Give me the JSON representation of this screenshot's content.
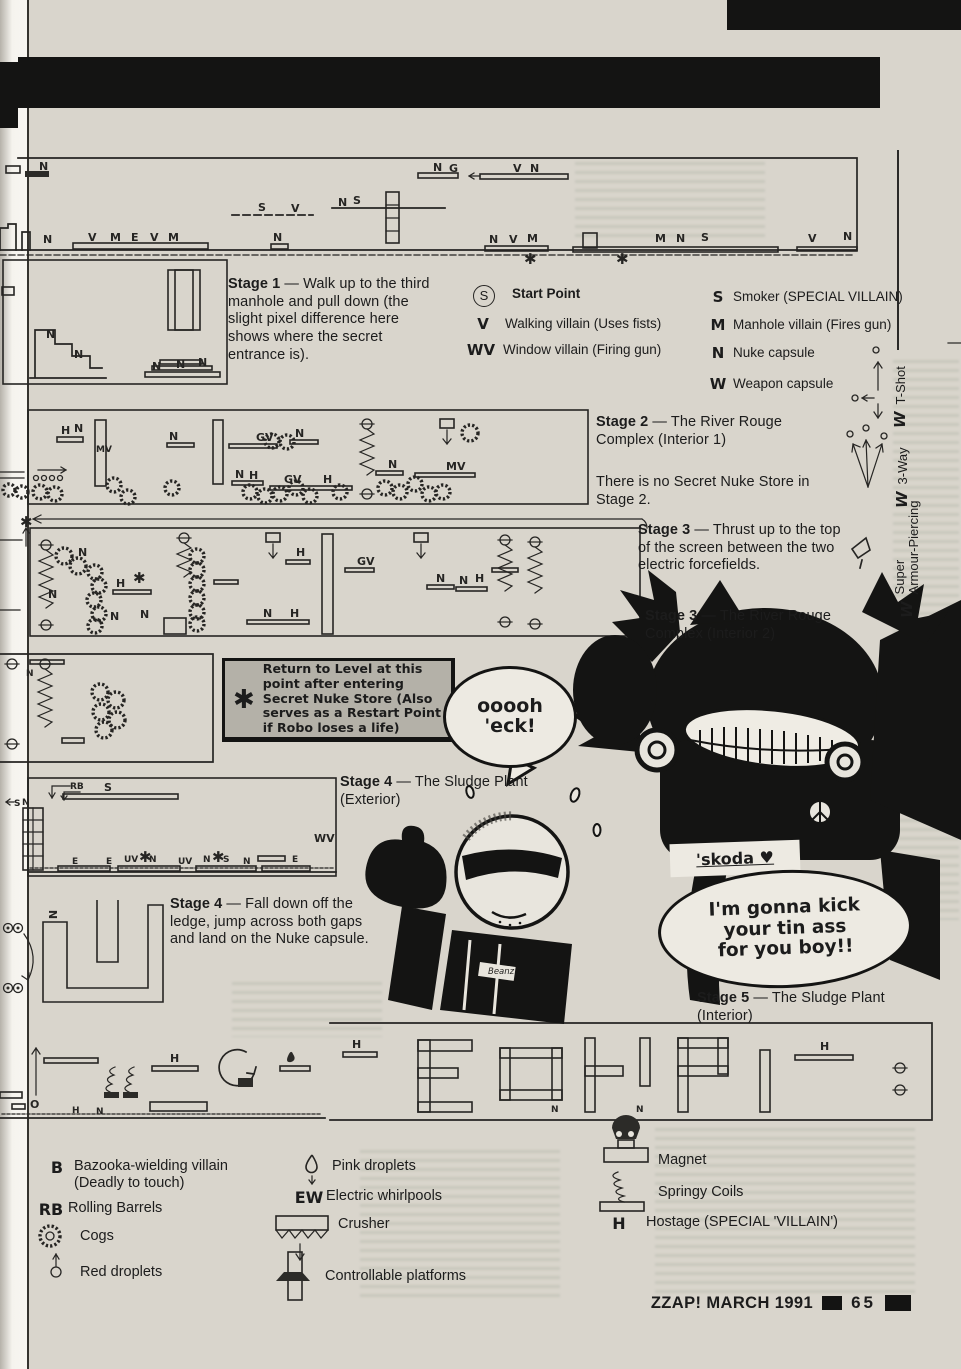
{
  "footer": {
    "title": "ZZAP! MARCH 1991",
    "page": "65"
  },
  "stage_notes": {
    "stage1": {
      "label": "Stage 1",
      "body": "— Walk up to the third manhole and pull down (the slight pixel difference here shows where the secret entrance is)."
    },
    "stage2": {
      "label": "Stage 2",
      "body": "— The River Rouge Complex (Interior 1)"
    },
    "stage2_note": "There is no Secret Nuke Store in Stage 2.",
    "stage3a": {
      "label": "Stage 3",
      "body": "— Thrust up to the top of the screen between the two electric forcefields."
    },
    "stage3b": {
      "label": "Stage 3",
      "body": "— The River Rouge Complex (Interior 2)"
    },
    "stage4a": {
      "label": "Stage 4",
      "body": "— The Sludge Plant (Exterior)"
    },
    "stage4b": {
      "label": "Stage 4",
      "body": "— Fall down off the ledge, jump across both gaps and land on the Nuke capsule."
    },
    "stage5": {
      "label": "Stage 5",
      "body": "— The Sludge Plant (Interior)"
    }
  },
  "restart_box": {
    "symbol": "✱",
    "text": "Return to Level at this point after entering Secret Nuke Store (Also serves as a Restart Point if Robo loses a life)"
  },
  "key_left": [
    {
      "symbol": "S",
      "label": "Start Point"
    },
    {
      "symbol": "V",
      "label": "Walking villain (Uses fists)"
    },
    {
      "symbol": "WV",
      "label": "Window villain (Firing gun)"
    }
  ],
  "key_right": [
    {
      "symbol": "S",
      "label": "Smoker (SPECIAL VILLAIN)"
    },
    {
      "symbol": "M",
      "label": "Manhole villain (Fires gun)"
    },
    {
      "symbol": "N",
      "label": "Nuke capsule"
    },
    {
      "symbol": "W",
      "label": "Weapon capsule"
    }
  ],
  "weapons": [
    {
      "symbol": "W",
      "label": "T-Shot"
    },
    {
      "symbol": "W",
      "label": "3-Way"
    },
    {
      "symbol": "W",
      "label_line1": "Super",
      "label_line2": "Armour-Piercing"
    }
  ],
  "legend_bottom": {
    "col1": [
      {
        "symbol": "B",
        "label": "Bazooka-wielding villain (Deadly to touch)"
      },
      {
        "symbol": "RB",
        "label": "Rolling Barrels"
      },
      {
        "icon": "cogs-icon",
        "label": "Cogs"
      },
      {
        "icon": "red-droplets-icon",
        "label": "Red droplets"
      }
    ],
    "col2": [
      {
        "icon": "pink-droplets-icon",
        "label": "Pink droplets"
      },
      {
        "symbol": "EW",
        "label": "Electric whirlpools"
      },
      {
        "icon": "crusher-icon",
        "label": "Crusher"
      },
      {
        "icon": "controllable-platforms-icon",
        "label": "Controllable platforms"
      }
    ],
    "col3": [
      {
        "icon": "magnet-icon",
        "label": "Magnet"
      },
      {
        "icon": "springy-coils-icon",
        "label": "Springy Coils"
      },
      {
        "symbol": "H",
        "label": "Hostage (SPECIAL 'VILLAIN')"
      }
    ]
  },
  "speech": {
    "robocop": "ooooh\n'eck!",
    "skoda": "'skoda ♥",
    "villain": "I'm gonna kick\nyour tin ass\nfor you boy!!"
  },
  "colors": {
    "paper": "#d9d5cc",
    "ink": "#262523",
    "bar_black": "#141413",
    "box_gray": "#b4b1a8"
  },
  "map_markers": [
    {
      "map": "strip1",
      "items": [
        [
          39,
          170,
          "N"
        ],
        [
          43,
          243,
          "N"
        ],
        [
          88,
          241,
          "V"
        ],
        [
          110,
          241,
          "M"
        ],
        [
          131,
          241,
          "E"
        ],
        [
          150,
          241,
          "V"
        ],
        [
          168,
          241,
          "M"
        ],
        [
          258,
          211,
          "S"
        ],
        [
          291,
          212,
          "V"
        ],
        [
          273,
          241,
          "N"
        ],
        [
          338,
          206,
          "N"
        ],
        [
          353,
          204,
          "S"
        ],
        [
          433,
          171,
          "N"
        ],
        [
          449,
          172,
          "G"
        ],
        [
          513,
          172,
          "V"
        ],
        [
          530,
          172,
          "N"
        ],
        [
          489,
          243,
          "N"
        ],
        [
          509,
          243,
          "V"
        ],
        [
          527,
          242,
          "M"
        ],
        [
          524,
          264,
          "✱",
          "big"
        ],
        [
          616,
          264,
          "✱",
          "big"
        ],
        [
          655,
          242,
          "M"
        ],
        [
          676,
          242,
          "N"
        ],
        [
          701,
          241,
          "S"
        ],
        [
          808,
          242,
          "V"
        ],
        [
          843,
          240,
          "N"
        ]
      ]
    },
    {
      "map": "inset1",
      "items": [
        [
          46,
          338,
          "N"
        ],
        [
          74,
          358,
          "N"
        ],
        [
          152,
          370,
          "N"
        ],
        [
          176,
          368,
          "N"
        ],
        [
          198,
          366,
          "N"
        ]
      ]
    },
    {
      "map": "strip2",
      "items": [
        [
          61,
          434,
          "H"
        ],
        [
          74,
          432,
          "N"
        ],
        [
          96,
          452,
          "MV",
          "sm"
        ],
        [
          169,
          440,
          "N"
        ],
        [
          256,
          441,
          "GV"
        ],
        [
          295,
          437,
          "N"
        ],
        [
          235,
          478,
          "N"
        ],
        [
          249,
          479,
          "H"
        ],
        [
          284,
          483,
          "GV"
        ],
        [
          323,
          483,
          "H"
        ],
        [
          388,
          468,
          "N"
        ],
        [
          446,
          470,
          "MV"
        ]
      ]
    },
    {
      "map": "strip3",
      "items": [
        [
          20,
          527,
          "✱",
          "big"
        ],
        [
          78,
          556,
          "N"
        ],
        [
          48,
          598,
          "N"
        ],
        [
          116,
          587,
          "H"
        ],
        [
          133,
          583,
          "✱",
          "big"
        ],
        [
          110,
          620,
          "N"
        ],
        [
          140,
          618,
          "N"
        ],
        [
          296,
          556,
          "H"
        ],
        [
          263,
          617,
          "N"
        ],
        [
          290,
          617,
          "H"
        ],
        [
          357,
          565,
          "GV"
        ],
        [
          436,
          582,
          "N"
        ],
        [
          459,
          584,
          "N"
        ],
        [
          475,
          582,
          "H"
        ]
      ]
    },
    {
      "map": "store",
      "items": [
        [
          26,
          676,
          "N",
          "sm"
        ]
      ]
    },
    {
      "map": "strip4",
      "items": [
        [
          70,
          789,
          "RB",
          "sm"
        ],
        [
          104,
          791,
          "S"
        ],
        [
          14,
          806,
          "S",
          "sm"
        ],
        [
          22,
          805,
          "N",
          "sm"
        ],
        [
          314,
          842,
          "WV"
        ],
        [
          72,
          864,
          "E",
          "sm"
        ],
        [
          106,
          864,
          "E",
          "sm"
        ],
        [
          124,
          862,
          "UV",
          "sm"
        ],
        [
          139,
          862,
          "✱",
          "big"
        ],
        [
          149,
          862,
          "N",
          "sm"
        ],
        [
          178,
          864,
          "UV",
          "sm"
        ],
        [
          203,
          862,
          "N",
          "sm"
        ],
        [
          212,
          862,
          "✱",
          "big"
        ],
        [
          223,
          862,
          "S",
          "sm"
        ],
        [
          243,
          864,
          "N",
          "sm"
        ],
        [
          292,
          862,
          "E",
          "sm"
        ]
      ]
    },
    {
      "map": "maze4",
      "items": [
        [
          48,
          918,
          "N",
          "rot"
        ]
      ]
    },
    {
      "map": "strip5",
      "items": [
        [
          30,
          1108,
          "O"
        ],
        [
          170,
          1062,
          "H"
        ],
        [
          72,
          1113,
          "H",
          "sm"
        ],
        [
          96,
          1114,
          "N",
          "sm"
        ],
        [
          352,
          1048,
          "H"
        ],
        [
          551,
          1112,
          "N",
          "sm"
        ],
        [
          636,
          1112,
          "N",
          "sm"
        ],
        [
          820,
          1050,
          "H"
        ]
      ]
    },
    {
      "map": "cartoon",
      "items": [
        [
          488,
          974,
          "Beanz",
          "script"
        ]
      ]
    }
  ]
}
